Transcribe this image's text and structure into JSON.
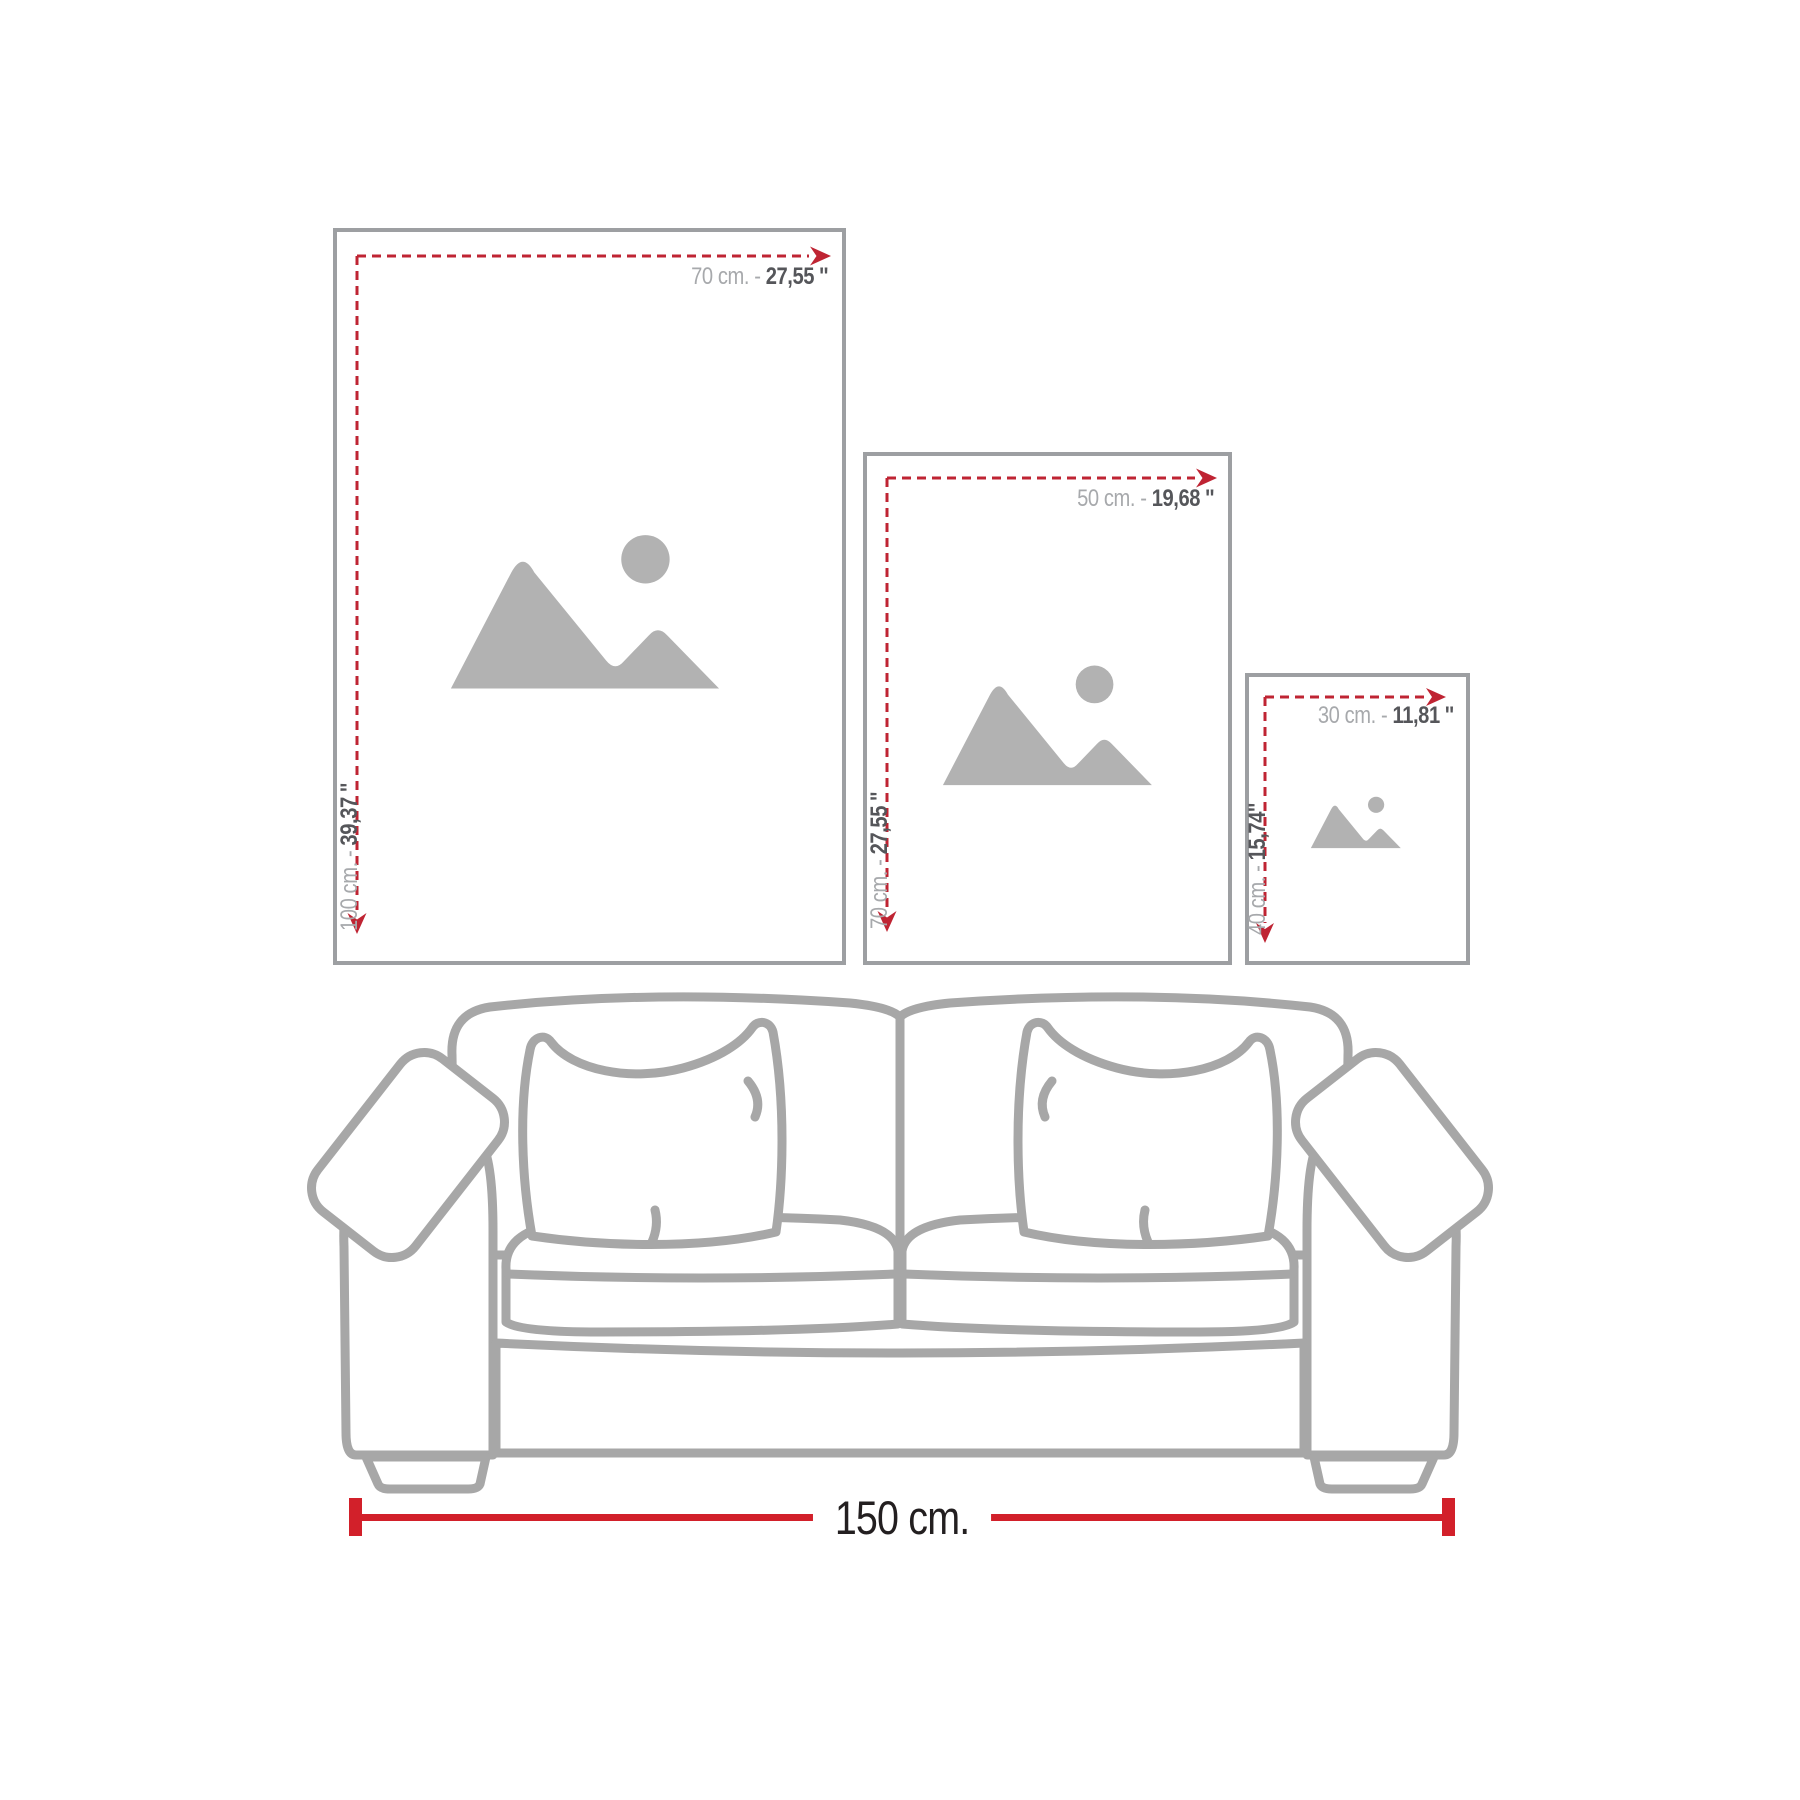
{
  "colors": {
    "background": "#ffffff",
    "frame_border": "#9d9fa2",
    "dash_red": "#bf2433",
    "solid_red": "#d2202a",
    "label_light": "#a7a9ac",
    "label_dark": "#55565a",
    "sofa_line": "#a7a7a7",
    "icon_gray": "#b2b2b2",
    "measure_text": "#231f20"
  },
  "frames": [
    {
      "size": "large",
      "width_cm": "70 cm. - ",
      "width_in": "27,55 ''",
      "height_cm": "100 cm. - ",
      "height_in": "39,37 ''"
    },
    {
      "size": "medium",
      "width_cm": "50 cm. - ",
      "width_in": "19,68 ''",
      "height_cm": "70 cm. - ",
      "height_in": "27,55 ''"
    },
    {
      "size": "small",
      "width_cm": "30 cm. - ",
      "width_in": "11,81 ''",
      "height_cm": "40 cm. - ",
      "height_in": "15,74''"
    }
  ],
  "sofa": {
    "width_label": "150 cm."
  }
}
